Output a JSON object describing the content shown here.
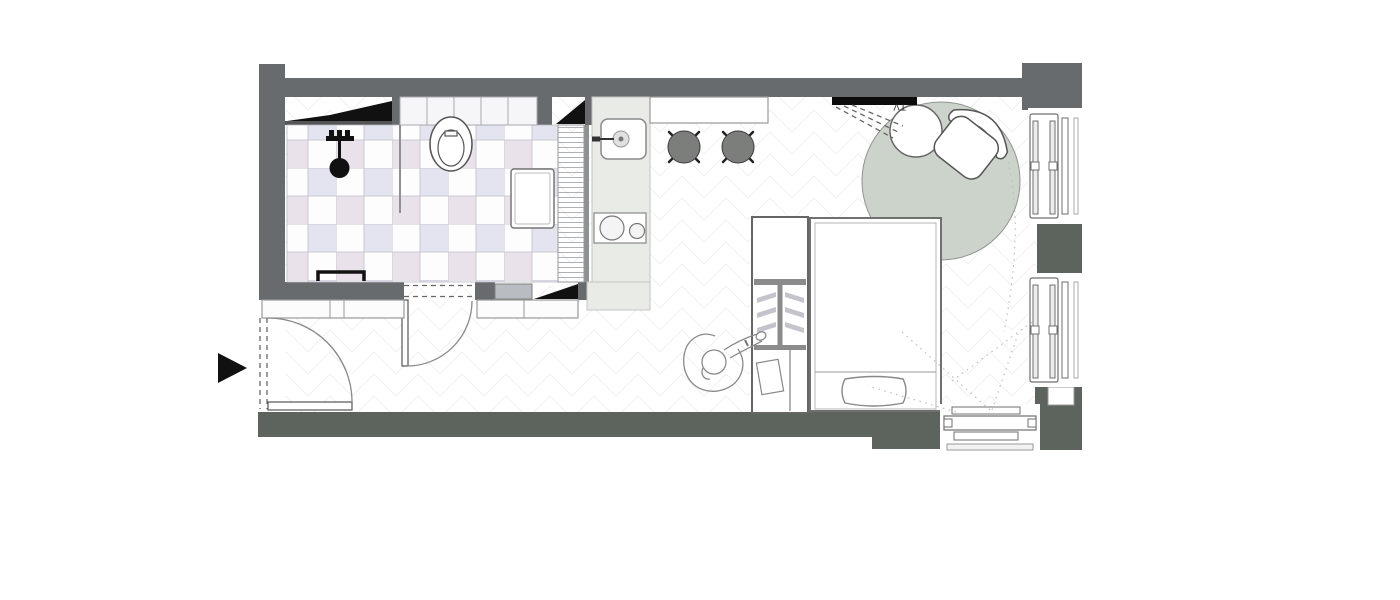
{
  "floorplan": {
    "tv_label": "TV",
    "colors": {
      "wall": "#676b6d",
      "wall_dark": "#5c645d",
      "counter": "#e9ebe7",
      "rug": "#ccd3ca",
      "stool": "#7b7e7b",
      "tile": "#e4e4f0",
      "tile_alt": "#e9e2ea",
      "ink": "#111111"
    },
    "objects": [
      "entry-arrow",
      "entry-door",
      "bathroom-tiled-floor",
      "shower-head",
      "shower-valves",
      "toilet",
      "vanity-unit",
      "towel-rail",
      "mirror-wedge",
      "sliding-panel",
      "bathroom-door",
      "hall-cabinets",
      "kitchen-counter",
      "kitchen-sink",
      "cooktop",
      "bar-counter",
      "bar-stool",
      "tv",
      "tv-sight-lines",
      "round-rug",
      "side-table",
      "armchair",
      "wardrobe",
      "bed",
      "pillow",
      "person-sketch",
      "window-radiator",
      "bottom-window-radiator"
    ]
  }
}
